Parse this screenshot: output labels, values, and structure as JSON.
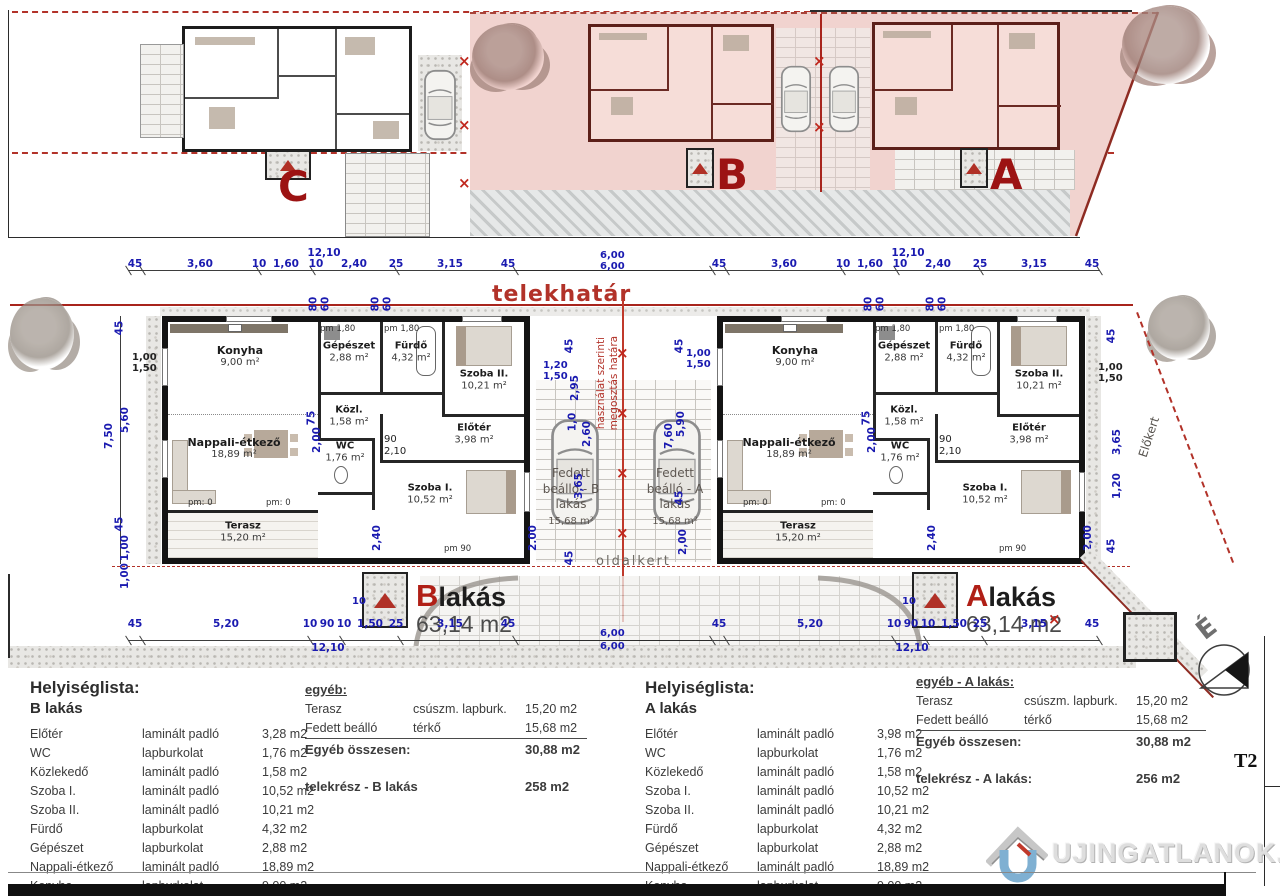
{
  "site": {
    "c": "C",
    "b": "B",
    "a": "A"
  },
  "plan": {
    "telekhatar": "telekhatár",
    "division1": "használat szerinti",
    "division2": "megosztás határa",
    "oldalkert": "oldalkert",
    "elokert": "Előkert",
    "pm": {
      "zero": "pm: 0",
      "n90": "pm 90",
      "n180": "pm 1,80"
    },
    "units": {
      "b": {
        "letter": "B",
        "word": "lakás",
        "area": "63,14 m2",
        "rooms": {
          "konyha": {
            "n": "Konyha",
            "a": "9,00 m²"
          },
          "gepeszet": {
            "n": "Gépészet",
            "a": "2,88 m²"
          },
          "furdo": {
            "n": "Fürdő",
            "a": "4,32 m²"
          },
          "szoba2": {
            "n": "Szoba II.",
            "a": "10,21 m²"
          },
          "nappali": {
            "n": "Nappali-étkező",
            "a": "18,89 m²"
          },
          "kozl": {
            "n": "Közl.",
            "a": "1,58 m²"
          },
          "eloter": {
            "n": "Előtér",
            "a": "3,98 m²"
          },
          "wc": {
            "n": "WC",
            "a": "1,76 m²"
          },
          "szoba1": {
            "n": "Szoba I.",
            "a": "10,52 m²"
          },
          "terasz": {
            "n": "Terasz",
            "a": "15,20 m²"
          }
        },
        "carport": {
          "l1": "Fedett",
          "l2": "beálló - B",
          "l3": "lakás",
          "a": "15,68 m²"
        }
      },
      "a": {
        "letter": "A",
        "word": "lakás",
        "area": "63,14 m2",
        "rooms": {
          "konyha": {
            "n": "Konyha",
            "a": "9,00 m²"
          },
          "gepeszet": {
            "n": "Gépészet",
            "a": "2,88 m²"
          },
          "furdo": {
            "n": "Fürdő",
            "a": "4,32 m²"
          },
          "szoba2": {
            "n": "Szoba II.",
            "a": "10,21 m²"
          },
          "nappali": {
            "n": "Nappali-étkező",
            "a": "18,89 m²"
          },
          "kozl": {
            "n": "Közl.",
            "a": "1,58 m²"
          },
          "eloter": {
            "n": "Előtér",
            "a": "3,98 m²"
          },
          "wc": {
            "n": "WC",
            "a": "1,76 m²"
          },
          "szoba1": {
            "n": "Szoba I.",
            "a": "10,52 m²"
          },
          "terasz": {
            "n": "Terasz",
            "a": "15,20 m²"
          }
        },
        "carport": {
          "l1": "Fedett",
          "l2": "beálló - A",
          "l3": "lakás",
          "a": "15,68 m²"
        }
      }
    }
  },
  "dims": {
    "top": [
      "45",
      "3,60",
      "10",
      "1,60",
      "10",
      "2,40",
      "25",
      "3,15",
      "45"
    ],
    "top_total": "12,10",
    "six": "6,00",
    "bottom": [
      "45",
      "5,20",
      "10",
      "90",
      "10",
      "1,50",
      "25",
      "3,15",
      "45"
    ],
    "bottom_total": "12,10",
    "leftv": [
      "45",
      "5,60",
      "45",
      "1,00"
    ],
    "leftv_total": "7,50",
    "v": {
      "v45": "45",
      "v100": "1,00",
      "v150": "1,50",
      "v120": "1,20",
      "v295": "2,95",
      "v75": "75",
      "v200": "2,00",
      "v210": "2,10",
      "v90": "90",
      "v240": "2,40",
      "v80": "80",
      "v60": "60",
      "v365": "3,65",
      "v260": "2,60",
      "v590": "5,90",
      "v760": "7,60",
      "v10": "1,0",
      "v10cm": "10"
    }
  },
  "tables": {
    "b": {
      "title": "Helyiséglista:",
      "subtitle": "B lakás",
      "rows": [
        {
          "name": "Előtér",
          "mat": "laminált padló",
          "val": "3,28 m2"
        },
        {
          "name": "WC",
          "mat": "lapburkolat",
          "val": "1,76 m2"
        },
        {
          "name": "Közlekedő",
          "mat": "laminált padló",
          "val": "1,58 m2"
        },
        {
          "name": "Szoba I.",
          "mat": "laminált padló",
          "val": "10,52 m2"
        },
        {
          "name": "Szoba II.",
          "mat": "laminált padló",
          "val": "10,21 m2"
        },
        {
          "name": "Fürdő",
          "mat": "lapburkolat",
          "val": "4,32 m2"
        },
        {
          "name": "Gépészet",
          "mat": "lapburkolat",
          "val": "2,88 m2"
        },
        {
          "name": "Nappali-étkező",
          "mat": "laminált padló",
          "val": "18,89 m2"
        },
        {
          "name": "Konyha",
          "mat": "lapburkolat",
          "val": "9,00 m2"
        }
      ],
      "total_label": "B lakás nettó összesen:",
      "total_val": "63,14 m²"
    },
    "b_other": {
      "title": "egyéb:",
      "rows": [
        {
          "name": "Terasz",
          "mat": "csúszm. lapburk.",
          "val": "15,20 m2"
        },
        {
          "name": "Fedett beálló",
          "mat": "térkő",
          "val": "15,68 m2"
        }
      ],
      "total_label": "Egyéb összesen:",
      "total_val": "30,88 m2",
      "parcel_label": "telekrész - B lakás",
      "parcel_val": "258 m2"
    },
    "a": {
      "title": "Helyiséglista:",
      "subtitle": "A lakás",
      "rows": [
        {
          "name": "Előtér",
          "mat": "laminált padló",
          "val": "3,98 m2"
        },
        {
          "name": "WC",
          "mat": "lapburkolat",
          "val": "1,76 m2"
        },
        {
          "name": "Közlekedő",
          "mat": "laminált padló",
          "val": "1,58 m2"
        },
        {
          "name": "Szoba I.",
          "mat": "laminált padló",
          "val": "10,52 m2"
        },
        {
          "name": "Szoba II.",
          "mat": "laminált padló",
          "val": "10,21 m2"
        },
        {
          "name": "Fürdő",
          "mat": "lapburkolat",
          "val": "4,32 m2"
        },
        {
          "name": "Gépészet",
          "mat": "lapburkolat",
          "val": "2,88 m2"
        },
        {
          "name": "Nappali-étkező",
          "mat": "laminált padló",
          "val": "18,89 m2"
        },
        {
          "name": "Konyha",
          "mat": "lapburkolat",
          "val": "9,00 m2"
        }
      ],
      "total_label": "A lakás nettó összesen:",
      "total_val": "63,14 m²"
    },
    "a_other": {
      "title": "egyéb - A lakás:",
      "rows": [
        {
          "name": "Terasz",
          "mat": "csúszm. lapburk.",
          "val": "15,20 m2"
        },
        {
          "name": "Fedett beálló",
          "mat": "térkő",
          "val": "15,68 m2"
        }
      ],
      "total_label": "Egyéb összesen:",
      "total_val": "30,88 m2",
      "parcel_label": "telekrész - A lakás:",
      "parcel_val": "256 m2"
    }
  },
  "footer": {
    "sheet": "T2",
    "north": "É",
    "logo": "UJINGATLANOK.HU"
  }
}
